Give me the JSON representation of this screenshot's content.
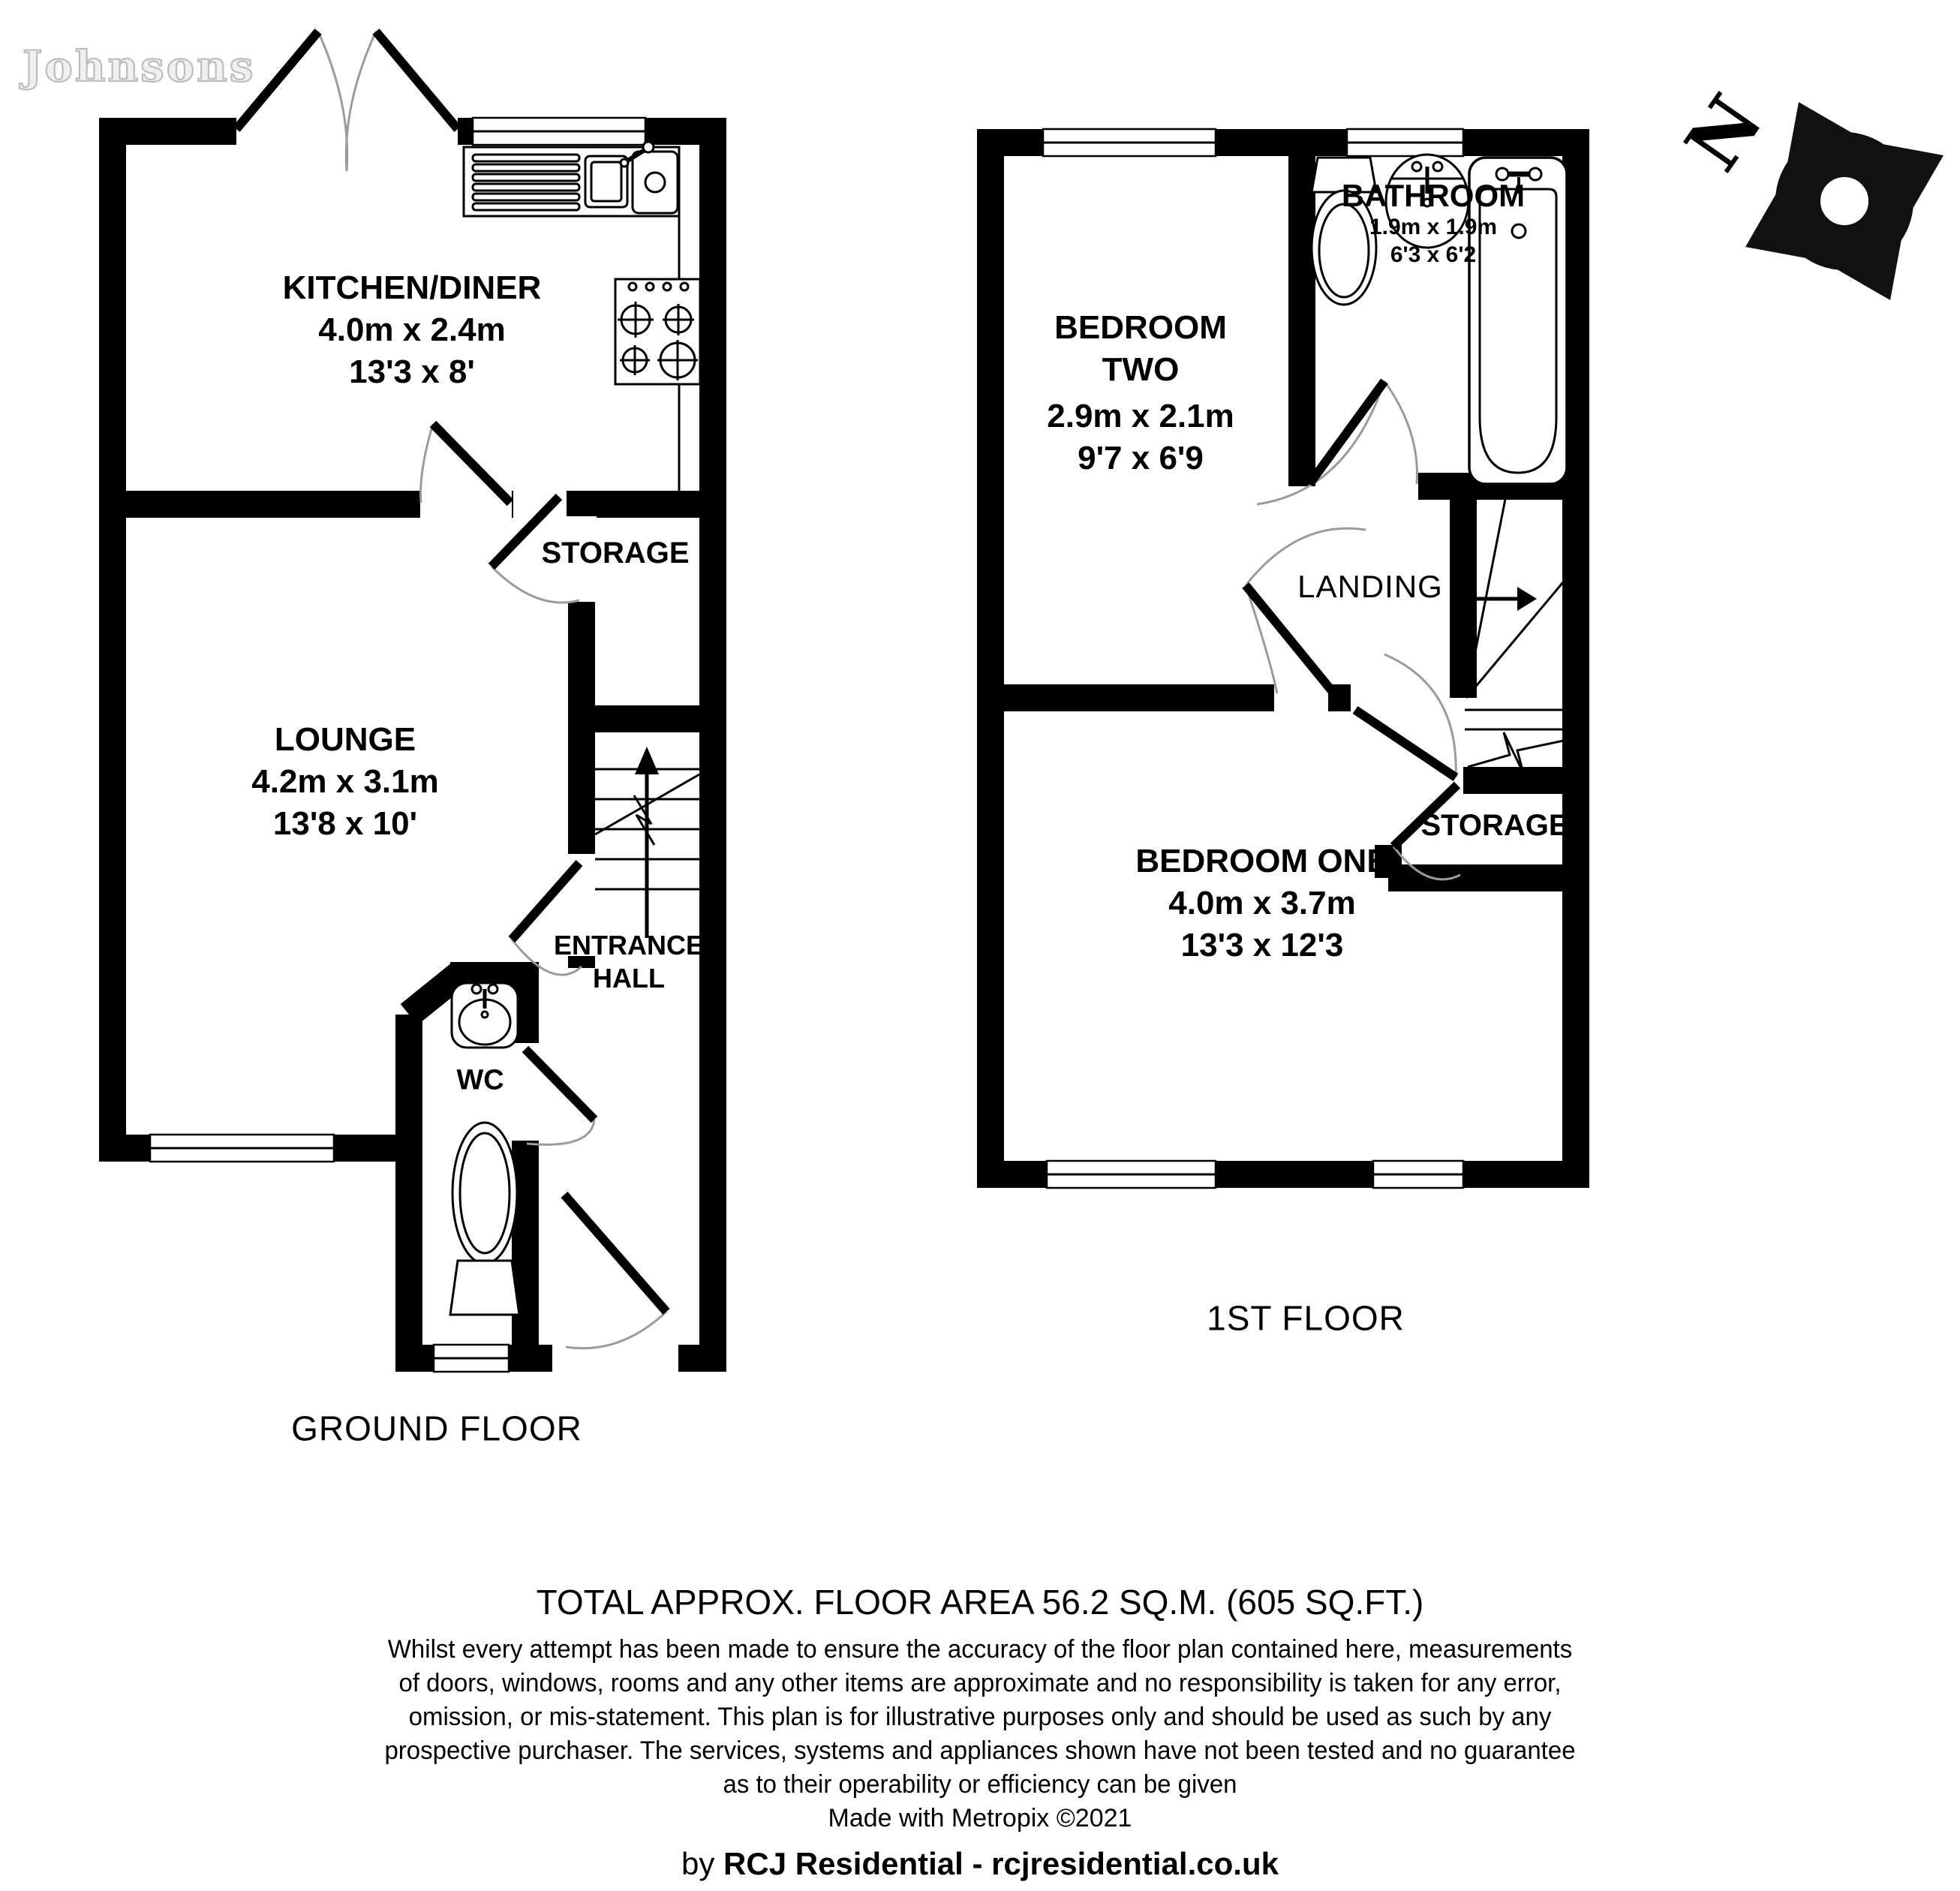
{
  "watermark": "Johnsons",
  "compass": {
    "north_label": "N"
  },
  "floors": {
    "ground": {
      "label": "GROUND FLOOR",
      "rooms": {
        "kitchen": {
          "name": "KITCHEN/DINER",
          "metric": "4.0m x 2.4m",
          "imperial": "13'3 x 8'"
        },
        "lounge": {
          "name": "LOUNGE",
          "metric": "4.2m x 3.1m",
          "imperial": "13'8 x 10'"
        },
        "storage": {
          "name": "STORAGE"
        },
        "entrance_hall": {
          "name_line1": "ENTRANCE",
          "name_line2": "HALL"
        },
        "wc": {
          "name": "WC"
        }
      }
    },
    "first": {
      "label": "1ST FLOOR",
      "rooms": {
        "bedroom_two": {
          "name_line1": "BEDROOM",
          "name_line2": "TWO",
          "metric": "2.9m x 2.1m",
          "imperial": "9'7 x 6'9"
        },
        "bathroom": {
          "name": "BATHROOM",
          "metric": "1.9m x 1.9m",
          "imperial": "6'3 x 6'2"
        },
        "landing": {
          "name": "LANDING"
        },
        "storage": {
          "name": "STORAGE"
        },
        "bedroom_one": {
          "name": "BEDROOM ONE",
          "metric": "4.0m x 3.7m",
          "imperial": "13'3 x 12'3"
        }
      }
    }
  },
  "footer": {
    "total_area": "TOTAL APPROX. FLOOR AREA 56.2 SQ.M. (605 SQ.FT.)",
    "disclaimer_lines": [
      "Whilst every attempt has been made to ensure the accuracy of the floor plan contained here, measurements",
      "of doors, windows, rooms and any other items are approximate and no responsibility is taken for any error,",
      "omission, or mis-statement. This plan is for illustrative purposes only and should be used as such by any",
      "prospective purchaser. The services, systems and appliances shown have not been tested and no guarantee",
      "as to their operability or efficiency can be given"
    ],
    "made_with": "Made with Metropix ©2021",
    "credit": {
      "prefix": "by ",
      "company": "RCJ Residential",
      "separator": " - ",
      "website": "rcjresidential.co.uk"
    }
  }
}
